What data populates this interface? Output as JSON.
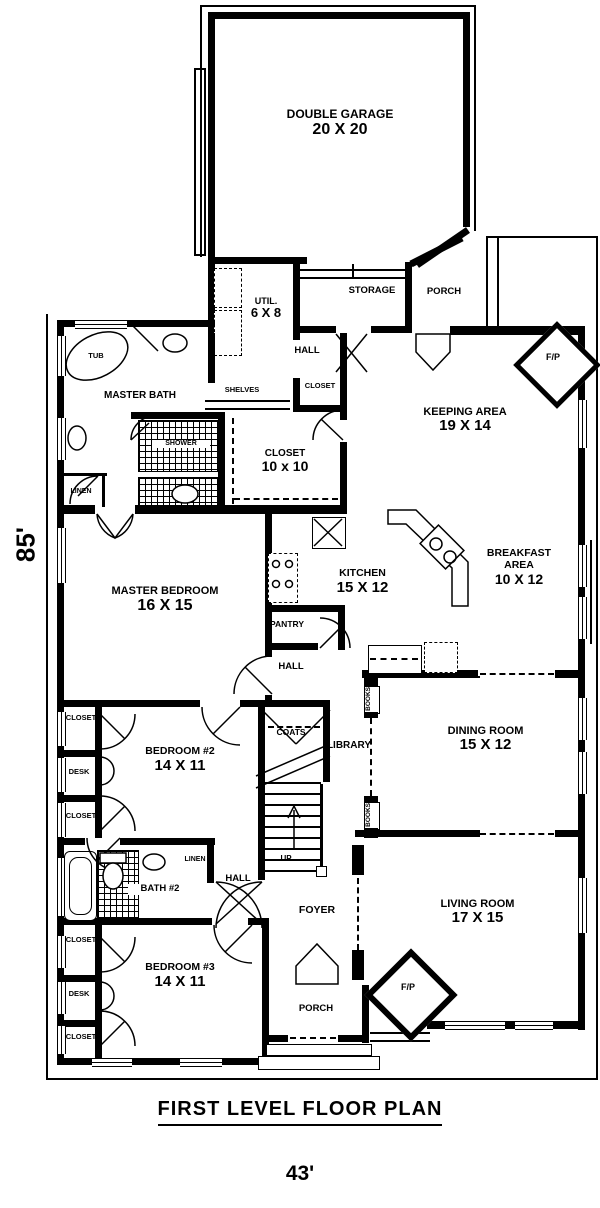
{
  "plan": {
    "title": "FIRST LEVEL FLOOR PLAN",
    "width_dim": "43'",
    "height_dim": "85'"
  },
  "labels": {
    "closet": "CLOSET",
    "desk": "DESK",
    "hall": "HALL",
    "linen": "LINEN",
    "porch": "PORCH",
    "books": "BOOKS",
    "fireplace": "F/P",
    "storage": "STORAGE",
    "shelves": "SHELVES",
    "shower": "SHOWER",
    "tub": "TUB",
    "pantry": "PANTRY",
    "coats": "COATS",
    "library": "LIBRARY",
    "foyer": "FOYER",
    "up": "UP",
    "bath2": "BATH #2"
  },
  "rooms": {
    "garage": {
      "name": "DOUBLE GARAGE",
      "dims": "20 X 20"
    },
    "util": {
      "name": "UTIL.",
      "dims": "6 X 8"
    },
    "keeping": {
      "name": "KEEPING AREA",
      "dims": "19 X 14"
    },
    "closet10": {
      "name": "CLOSET",
      "dims": "10 x 10"
    },
    "master_bath": {
      "name": "MASTER BATH"
    },
    "master_bedroom": {
      "name": "MASTER BEDROOM",
      "dims": "16 X 15"
    },
    "kitchen": {
      "name": "KITCHEN",
      "dims": "15 X 12"
    },
    "breakfast": {
      "name": "BREAKFAST AREA",
      "dims": "10 X 12"
    },
    "dining": {
      "name": "DINING ROOM",
      "dims": "15 X 12"
    },
    "bedroom2": {
      "name": "BEDROOM #2",
      "dims": "14 X 11"
    },
    "bedroom3": {
      "name": "BEDROOM #3",
      "dims": "14 X 11"
    },
    "living": {
      "name": "LIVING ROOM",
      "dims": "17 X 15"
    }
  }
}
